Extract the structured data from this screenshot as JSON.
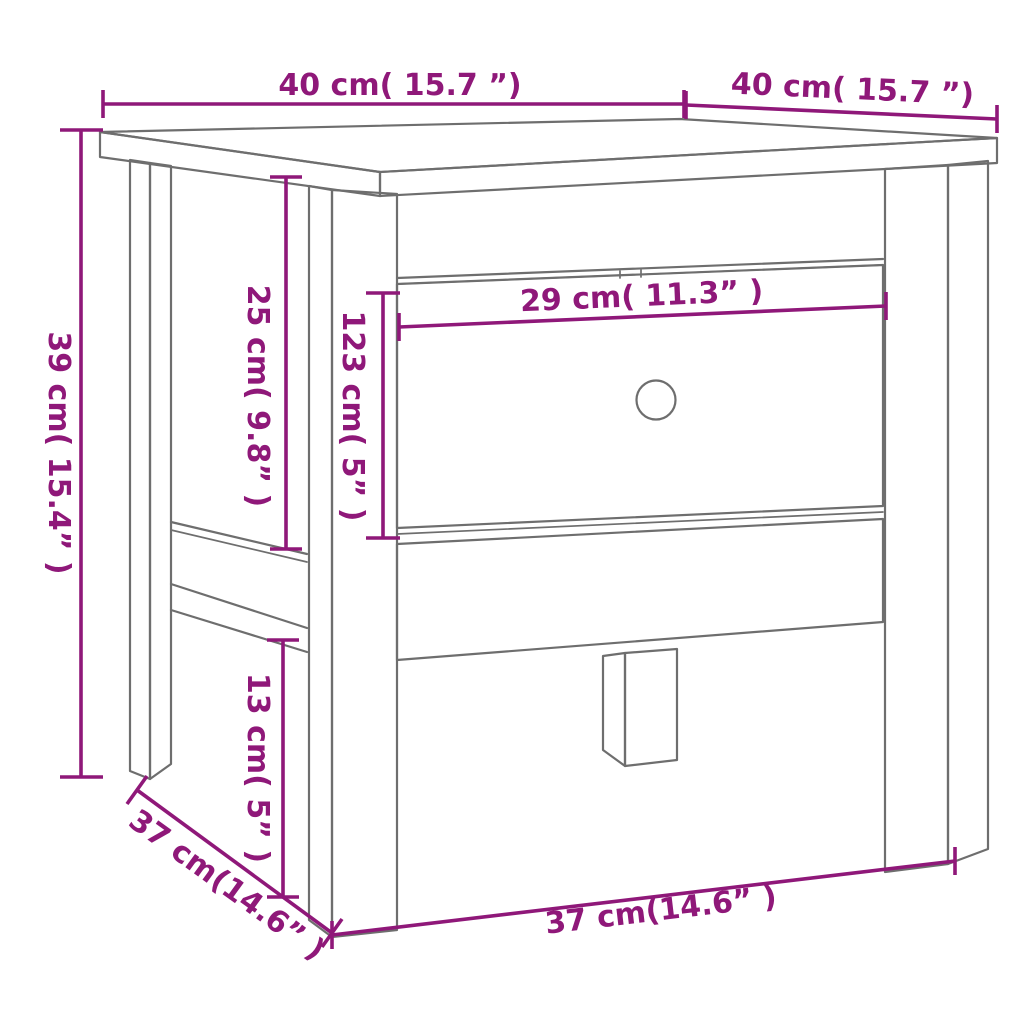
{
  "diagram": {
    "kind": "furniture-dimension-line-drawing",
    "colors": {
      "dimension": "#8F1879",
      "line": "#6E6E6E",
      "background": "#FFFFFF"
    },
    "dimensions": [
      {
        "id": "top-depth",
        "label": "40 cm( 15.7 ”)"
      },
      {
        "id": "top-width",
        "label": "40 cm( 15.7 ”)"
      },
      {
        "id": "overall-height",
        "label": "39 cm( 15.4” )"
      },
      {
        "id": "apron-height",
        "label": "25 cm( 9.8” )"
      },
      {
        "id": "drawer-front-height",
        "label": "123 cm( 5” )"
      },
      {
        "id": "drawer-width",
        "label": "29 cm( 11.3” )"
      },
      {
        "id": "leg-clearance-height",
        "label": "13 cm( 5” )"
      },
      {
        "id": "base-depth",
        "label": "37 cm(14.6” )"
      },
      {
        "id": "base-width",
        "label": "37 cm(14.6” )"
      }
    ]
  }
}
